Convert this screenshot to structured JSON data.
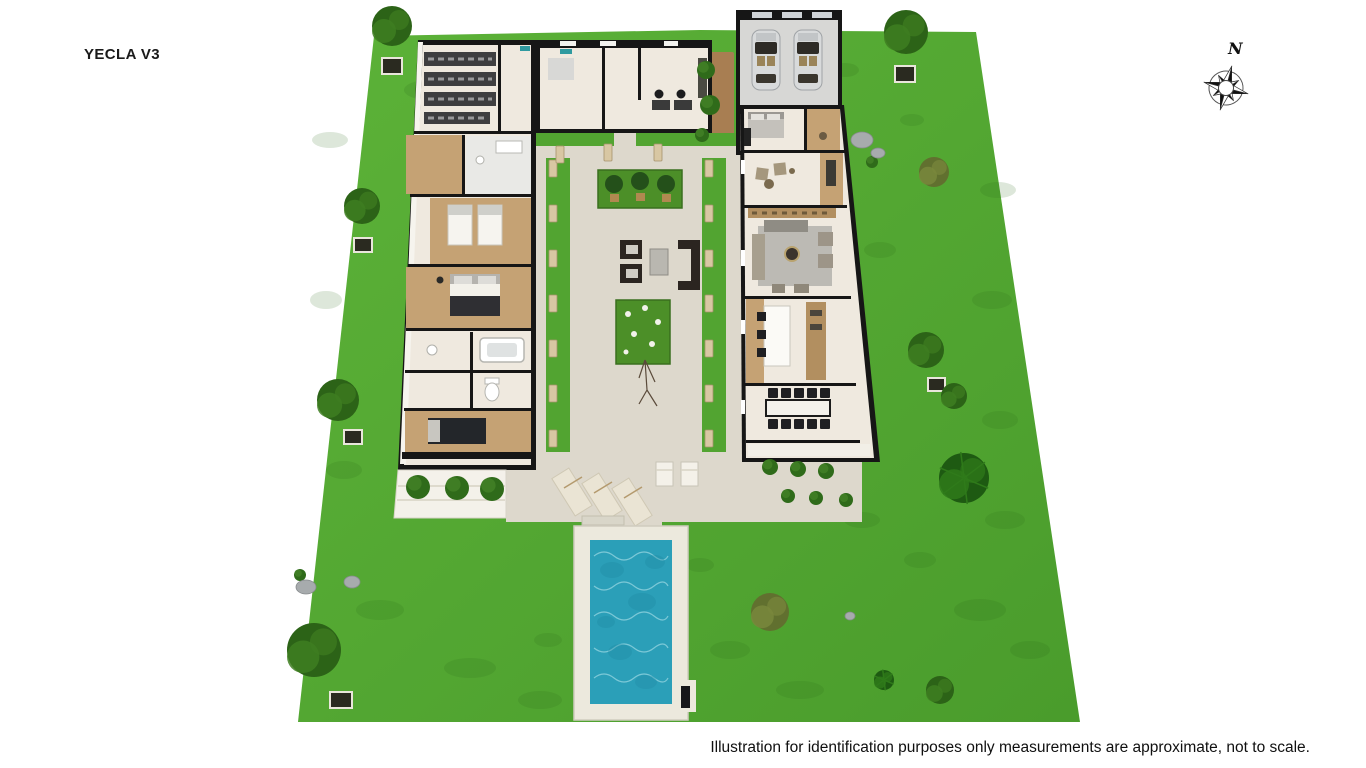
{
  "header": {
    "title": "YECLA V3"
  },
  "compass": {
    "label": "N"
  },
  "footer": {
    "disclaimer": "Illustration for identification purposes only measurements are approximate, not to scale."
  },
  "palette": {
    "background": "#ffffff",
    "lawn": "#55a733",
    "lawn_shadow": "#2e6b1a",
    "pavement": "#ddd8cc",
    "pool_water": "#2b9fb8",
    "pool_deck": "#ece9dd",
    "wall": "#161616",
    "floor": "#efe9df",
    "wood": "#c5a274",
    "tree_dark": "#2c6317",
    "tree_olive": "#61702f",
    "palm": "#1e5a12",
    "pillar": "#d8c7a3",
    "planter_green": "#4c8f28",
    "text": "#111111"
  },
  "scene": {
    "lawn_patches": [
      [
        430,
        90,
        26,
        10
      ],
      [
        330,
        140,
        18,
        8
      ],
      [
        326,
        300,
        16,
        9
      ],
      [
        344,
        470,
        18,
        9
      ],
      [
        380,
        610,
        24,
        10
      ],
      [
        470,
        668,
        26,
        10
      ],
      [
        540,
        700,
        22,
        9
      ],
      [
        548,
        640,
        14,
        7
      ],
      [
        730,
        650,
        20,
        9
      ],
      [
        800,
        690,
        24,
        9
      ],
      [
        980,
        610,
        26,
        11
      ],
      [
        1005,
        520,
        20,
        9
      ],
      [
        1000,
        420,
        18,
        9
      ],
      [
        992,
        300,
        20,
        9
      ],
      [
        998,
        190,
        18,
        8
      ],
      [
        880,
        250,
        16,
        8
      ],
      [
        862,
        520,
        18,
        8
      ],
      [
        920,
        560,
        16,
        8
      ],
      [
        700,
        565,
        14,
        7
      ],
      [
        845,
        70,
        14,
        7
      ],
      [
        912,
        120,
        12,
        6
      ],
      [
        1030,
        650,
        20,
        9
      ]
    ],
    "trees": [
      {
        "x": 392,
        "y": 26,
        "r": 20,
        "type": "dark",
        "planter": [
          382,
          58,
          20,
          16
        ]
      },
      {
        "x": 362,
        "y": 206,
        "r": 18,
        "type": "dark",
        "planter": [
          354,
          238,
          18,
          14
        ]
      },
      {
        "x": 338,
        "y": 400,
        "r": 21,
        "type": "dark",
        "planter": [
          344,
          430,
          18,
          14
        ]
      },
      {
        "x": 314,
        "y": 650,
        "r": 27,
        "type": "dark",
        "planter": [
          330,
          692,
          22,
          16
        ]
      },
      {
        "x": 906,
        "y": 32,
        "r": 22,
        "type": "dark",
        "planter": [
          895,
          66,
          20,
          16
        ]
      },
      {
        "x": 934,
        "y": 172,
        "r": 15,
        "type": "olive"
      },
      {
        "x": 926,
        "y": 350,
        "r": 18,
        "type": "dark",
        "planter": [
          928,
          378,
          17,
          13
        ]
      },
      {
        "x": 954,
        "y": 396,
        "r": 13,
        "type": "dark"
      },
      {
        "x": 964,
        "y": 478,
        "r": 25,
        "type": "palm"
      },
      {
        "x": 770,
        "y": 612,
        "r": 19,
        "type": "olive"
      },
      {
        "x": 940,
        "y": 690,
        "r": 14,
        "type": "dark"
      },
      {
        "x": 884,
        "y": 680,
        "r": 10,
        "type": "palm"
      }
    ],
    "pillars": {
      "left_x": 549,
      "right_x": 705,
      "ys": [
        160,
        205,
        250,
        295,
        340,
        385,
        430
      ],
      "top_row": [
        [
          556,
          146
        ],
        [
          604,
          144
        ],
        [
          654,
          144
        ]
      ]
    },
    "bushes": [
      [
        418,
        487,
        12
      ],
      [
        457,
        488,
        12
      ],
      [
        492,
        489,
        12
      ],
      [
        770,
        467,
        8
      ],
      [
        798,
        469,
        8
      ],
      [
        826,
        471,
        8
      ],
      [
        788,
        496,
        7
      ],
      [
        816,
        498,
        7
      ],
      [
        846,
        500,
        7
      ],
      [
        706,
        70,
        9
      ],
      [
        710,
        105,
        10
      ],
      [
        702,
        135,
        7
      ],
      [
        872,
        162,
        6
      ],
      [
        300,
        575,
        6
      ]
    ],
    "rocks": [
      [
        862,
        140,
        11,
        8
      ],
      [
        878,
        153,
        7,
        5
      ],
      [
        306,
        587,
        10,
        7
      ],
      [
        352,
        582,
        8,
        6
      ],
      [
        850,
        616,
        5,
        4
      ]
    ]
  }
}
